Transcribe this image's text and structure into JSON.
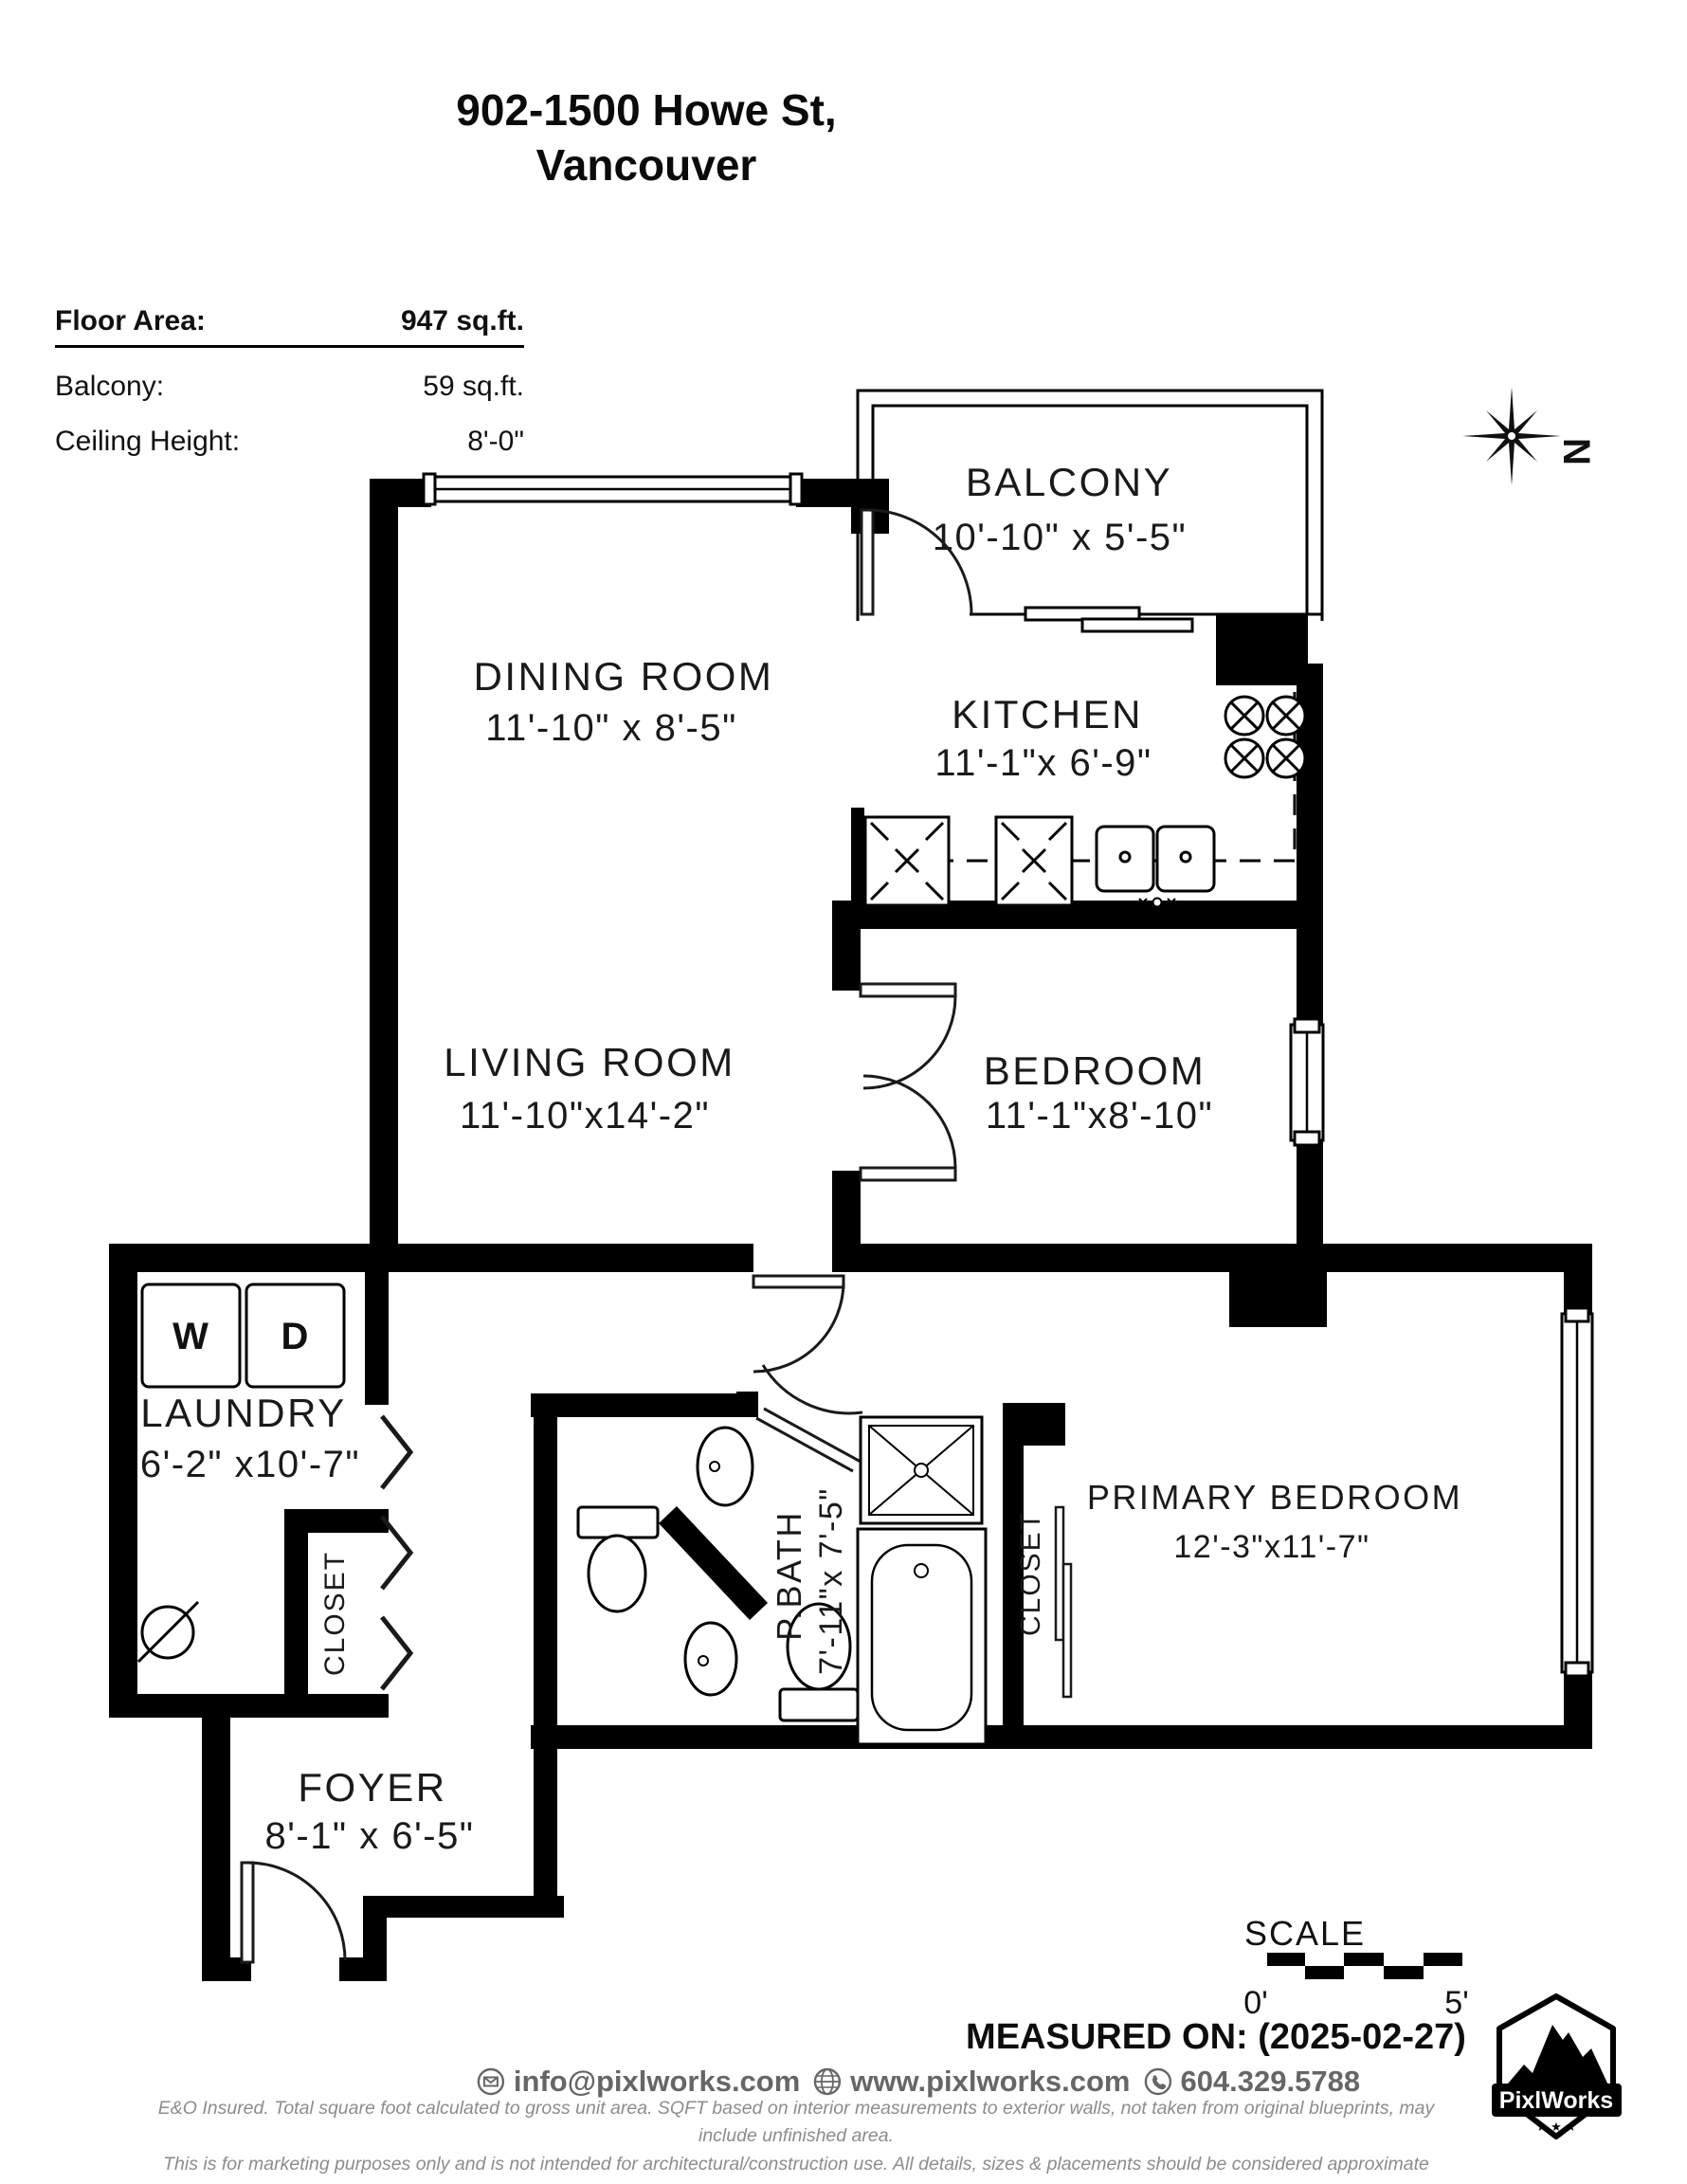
{
  "title": {
    "line1": "902-1500 Howe St,",
    "line2": "Vancouver"
  },
  "info": {
    "floor_area_label": "Floor Area:",
    "floor_area_value": "947 sq.ft.",
    "balcony_label": "Balcony:",
    "balcony_value": "59 sq.ft.",
    "ceiling_label": "Ceiling Height:",
    "ceiling_value": "8'-0\""
  },
  "compass": {
    "north_label": "N",
    "icon": "compass-rose-icon"
  },
  "rooms": {
    "balcony": {
      "name": "BALCONY",
      "dims": "10'-10\" x 5'-5\""
    },
    "dining": {
      "name": "DINING ROOM",
      "dims": "11'-10\" x 8'-5\""
    },
    "kitchen": {
      "name": "KITCHEN",
      "dims": "11'-1\"x 6'-9\""
    },
    "living": {
      "name": "LIVING ROOM",
      "dims": "11'-10\"x14'-2\""
    },
    "bedroom": {
      "name": "BEDROOM",
      "dims": "11'-1\"x8'-10\""
    },
    "laundry": {
      "name": "LAUNDRY",
      "dims": "6'-2\" x10'-7\""
    },
    "pbath": {
      "name": "P.BATH",
      "dims": "7'-11\"x 7'-5\""
    },
    "primary": {
      "name": "PRIMARY BEDROOM",
      "dims": "12'-3\"x11'-7\""
    },
    "foyer": {
      "name": "FOYER",
      "dims": "8'-1\" x 6'-5\""
    },
    "closet_hall": {
      "name": "CLOSET"
    },
    "closet_primary": {
      "name": "CLOSET"
    }
  },
  "fixtures": {
    "washer": "W",
    "dryer": "D"
  },
  "scale": {
    "label": "SCALE",
    "start": "0'",
    "end": "5'"
  },
  "footer": {
    "measured_on": "MEASURED ON: (2025-02-27)",
    "email": "info@pixlworks.com",
    "website": "www.pixlworks.com",
    "phone": "604.329.5788",
    "icons": [
      "email-icon",
      "globe-icon",
      "phone-icon"
    ],
    "disclaimer1": "E&O Insured.  Total square foot calculated to gross unit area. SQFT based on interior measurements to exterior walls, not taken from original blueprints, may include unfinished area.",
    "disclaimer2": "This is for marketing purposes only and is not intended for architectural/construction use.  All details, sizes & placements should be considered approximate within +/- 2%  tolerance."
  },
  "logo": {
    "brand": "PixlWorks",
    "stars": "★ ★ ★",
    "icon": "mountain-badge-icon"
  },
  "colors": {
    "wall": "#000000",
    "label": "#1a1a1a",
    "muted_text": "#666666",
    "fine_print": "#8c8c8c"
  }
}
